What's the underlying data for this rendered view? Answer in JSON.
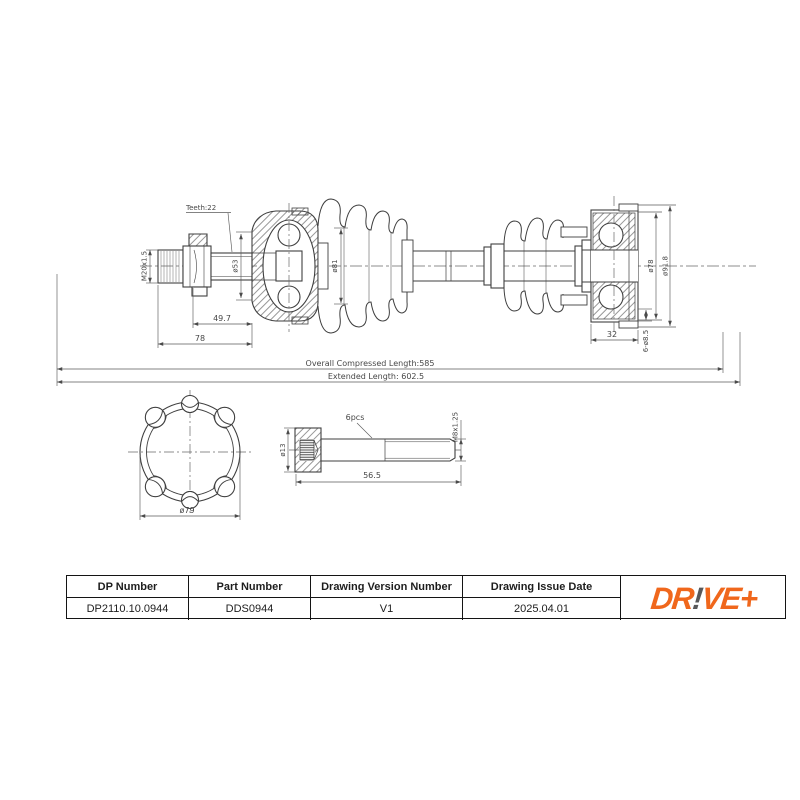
{
  "drawing": {
    "main_view": {
      "teeth_label": "Teeth:22",
      "thread_spec": "M20x1.5",
      "bell_inner_dia": "ø53",
      "boot_dia": "ø81",
      "spline_length": "49.7",
      "stub_length": "78",
      "flange_inner_dia": "ø78",
      "flange_outer_dia": "ø91.8",
      "bolt_holes": "6-ø8.5",
      "flange_width": "32",
      "compressed_length": "Overall Compressed Length:585",
      "extended_length": "Extended Length: 602.5"
    },
    "section_view": {
      "outer_dia": "ø79"
    },
    "bolt_view": {
      "quantity": "6pcs",
      "head_dia": "ø13",
      "thread_spec": "M8x1.25",
      "shank_length": "56.5"
    }
  },
  "title_block": {
    "headers": {
      "dp_number": "DP Number",
      "part_number": "Part Number",
      "version": "Drawing Version Number",
      "issue_date": "Drawing Issue Date"
    },
    "values": {
      "dp_number": "DP2110.10.0944",
      "part_number": "DDS0944",
      "version": "V1",
      "issue_date": "2025.04.01"
    }
  },
  "logo": {
    "prefix": "DR",
    "bang": "!",
    "suffix": "VE+"
  },
  "colors": {
    "accent_orange": "#F0671C",
    "bang_gray": "#58585A",
    "line": "#3F3F3F"
  }
}
